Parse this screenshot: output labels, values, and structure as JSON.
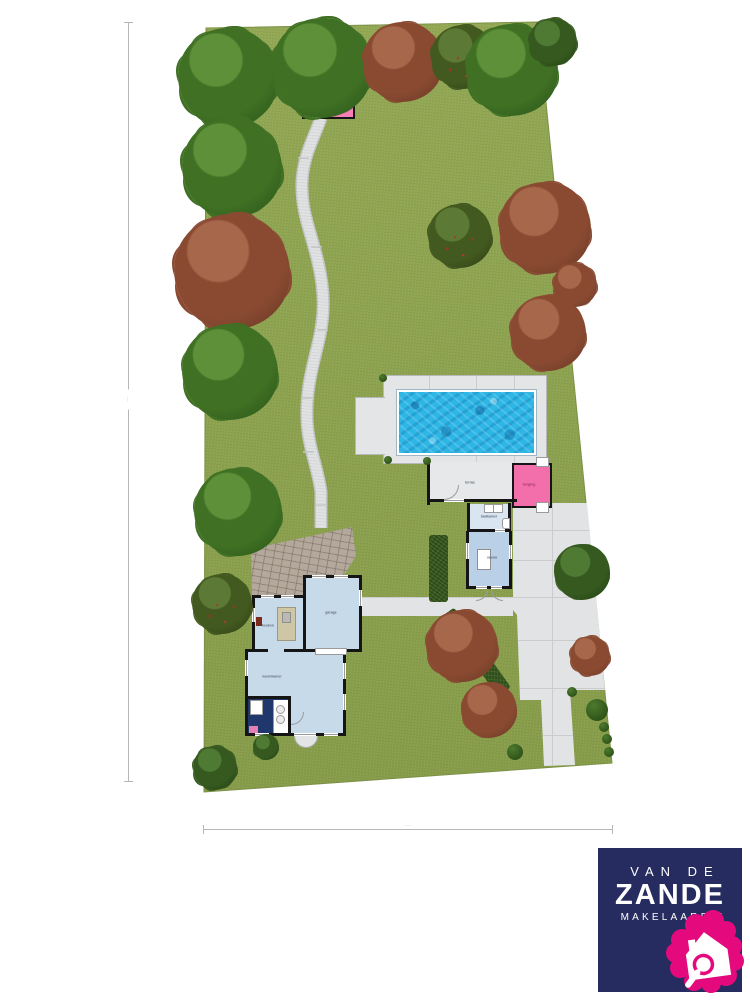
{
  "title": "garden site plan with house, pool house and swimming pool",
  "logo": {
    "line1": "VAN DE",
    "line2": "ZANDE",
    "line3": "MAKELAARDIJ",
    "bg_color": "#262c5f",
    "pink": "#e40a7d"
  },
  "labels": {
    "terrace": "terras",
    "bathroom": "badkamer",
    "sauna": "sauna",
    "storage": "berging",
    "kitchen": "keuken",
    "garage": "garage",
    "living": "woonkamer"
  },
  "dimensions": {
    "left": "·····",
    "bottom": "·····"
  },
  "colors": {
    "lawn": "#8ca14e",
    "path": "#e0e1e3",
    "deck": "#e4e5e7",
    "paving": "#e2e3e5",
    "pool_water": "#2eb6e5",
    "shed_pink": "#f87fb5",
    "room_pink": "#f36fab",
    "room_blue": "#c7daea",
    "bath_blue": "#d9e5f1",
    "sauna_blue": "#bad0e7",
    "kitchen_navy": "#20376b",
    "wall": "#151515",
    "hedge": "#3a5a24"
  },
  "scene": {
    "trees": [
      {
        "x": 228,
        "y": 78,
        "r": 50,
        "type": "green"
      },
      {
        "x": 322,
        "y": 68,
        "r": 50,
        "type": "green"
      },
      {
        "x": 403,
        "y": 62,
        "r": 40,
        "type": "red"
      },
      {
        "x": 463,
        "y": 57,
        "r": 32,
        "type": "greenred"
      },
      {
        "x": 512,
        "y": 70,
        "r": 46,
        "type": "green"
      },
      {
        "x": 553,
        "y": 42,
        "r": 24,
        "type": "darkgreen"
      },
      {
        "x": 232,
        "y": 168,
        "r": 50,
        "type": "green"
      },
      {
        "x": 545,
        "y": 228,
        "r": 46,
        "type": "red"
      },
      {
        "x": 232,
        "y": 272,
        "r": 58,
        "type": "red"
      },
      {
        "x": 460,
        "y": 236,
        "r": 32,
        "type": "greenred"
      },
      {
        "x": 575,
        "y": 285,
        "r": 22,
        "type": "red"
      },
      {
        "x": 548,
        "y": 333,
        "r": 38,
        "type": "red"
      },
      {
        "x": 230,
        "y": 372,
        "r": 48,
        "type": "green"
      },
      {
        "x": 238,
        "y": 512,
        "r": 44,
        "type": "green"
      },
      {
        "x": 222,
        "y": 604,
        "r": 30,
        "type": "greenred"
      },
      {
        "x": 582,
        "y": 572,
        "r": 28,
        "type": "darkgreen"
      },
      {
        "x": 462,
        "y": 646,
        "r": 36,
        "type": "red"
      },
      {
        "x": 590,
        "y": 656,
        "r": 20,
        "type": "red"
      },
      {
        "x": 489,
        "y": 710,
        "r": 28,
        "type": "red"
      },
      {
        "x": 215,
        "y": 768,
        "r": 22,
        "type": "darkgreen"
      },
      {
        "x": 266,
        "y": 747,
        "r": 13,
        "type": "darkgreen"
      }
    ],
    "bushes": [
      {
        "x": 383,
        "y": 378,
        "r": 4
      },
      {
        "x": 388,
        "y": 460,
        "r": 4
      },
      {
        "x": 427,
        "y": 461,
        "r": 4
      },
      {
        "x": 572,
        "y": 692,
        "r": 5
      },
      {
        "x": 597,
        "y": 710,
        "r": 11
      },
      {
        "x": 604,
        "y": 727,
        "r": 5
      },
      {
        "x": 607,
        "y": 739,
        "r": 5
      },
      {
        "x": 609,
        "y": 752,
        "r": 5
      },
      {
        "x": 515,
        "y": 752,
        "r": 8
      }
    ]
  }
}
